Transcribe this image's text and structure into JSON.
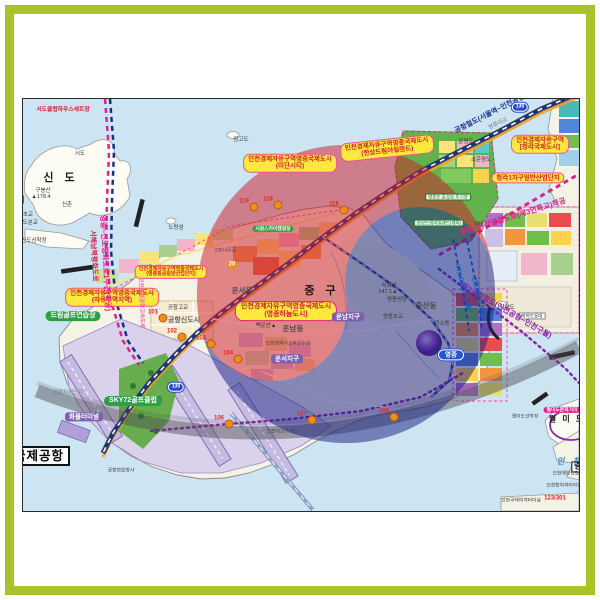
{
  "palette": {
    "frame_green": "#a9c32b",
    "water": "#cde4f3",
    "land": "#f5f2e6",
    "taegeuk_red": "rgba(205,30,45,0.52)",
    "taegeuk_blue": "rgba(30,35,130,0.52)",
    "swoosh_gray": "rgba(74,74,80,0.45)",
    "fez_label_bg": "#ffe93d",
    "fez_label_text": "#d61f2c"
  },
  "map": {
    "labels": [
      {
        "name": "label-midan-city",
        "cls": "fez",
        "x": 289,
        "y": 162,
        "lines": [
          "인천경제자유구역영종국제도시",
          "(미단시티)"
        ]
      },
      {
        "name": "label-hansang-dream-island",
        "cls": "fez",
        "x": 386,
        "y": 147,
        "rot": -6,
        "lines": [
          "인천경제자유구역영종국제도시",
          "(한상드림아일랜드)"
        ]
      },
      {
        "name": "label-cheongna-city",
        "cls": "fez",
        "x": 539,
        "y": 143,
        "lines": [
          "인천경제자유구역",
          "[청라국제도시]"
        ]
      },
      {
        "name": "label-cheongna1-industrial",
        "cls": "fez",
        "x": 527,
        "y": 177,
        "lines": [
          "청라1지구일반산업단지"
        ]
      },
      {
        "name": "label-yeongjong-aviation-industrial",
        "cls": "fez-sm",
        "x": 170,
        "y": 271,
        "lines": [
          "인천경제자유구역영종국제도시",
          "(영종항공일반산업단지)"
        ]
      },
      {
        "name": "label-free-trade-zone",
        "cls": "fez",
        "x": 111,
        "y": 296,
        "lines": [
          "인천경제자유구역영종국제도시",
          "(자유무역지역)"
        ]
      },
      {
        "name": "label-yeongjong-sky-city",
        "cls": "fez-strong",
        "x": 285,
        "y": 310,
        "lines": [
          "인천경제자유구역영종국제도시",
          "(영종하늘도시)"
        ]
      },
      {
        "name": "label-dream-golf-range",
        "cls": "green",
        "x": 72,
        "y": 315,
        "lines": [
          "드림골프연습장"
        ]
      },
      {
        "name": "label-sky72-golf-club",
        "cls": "green",
        "x": 132,
        "y": 400,
        "lines": [
          "SKY72골프클럽"
        ]
      },
      {
        "name": "label-seaside-camp",
        "cls": "green-sm",
        "x": 272,
        "y": 228,
        "lines": [
          "시원스카이캠핑장"
        ]
      },
      {
        "name": "label-dredged-soil-site",
        "cls": "wg-tiny",
        "x": 447,
        "y": 196,
        "lines": [
          "영종도 준설토 투기장"
        ]
      },
      {
        "name": "label-hansang-dream-planned",
        "cls": "wg-tiny",
        "x": 438,
        "y": 222,
        "lines": [
          "한상드림아일랜드(계획)"
        ]
      },
      {
        "name": "label-cargo-terminal",
        "cls": "purple",
        "x": 83,
        "y": 416,
        "lines": [
          "화물터미널"
        ]
      },
      {
        "name": "label-unnam-district",
        "cls": "purple",
        "x": 347,
        "y": 316,
        "lines": [
          "운남지구"
        ]
      },
      {
        "name": "label-unseo-district",
        "cls": "purple",
        "x": 286,
        "y": 358,
        "lines": [
          "운서지구"
        ]
      },
      {
        "name": "label-wolmido-culture-street",
        "cls": "pink",
        "x": 561,
        "y": 409,
        "lines": [
          "월미도문화거리"
        ]
      },
      {
        "name": "label-international-airport",
        "cls": "airport-box",
        "x": 38,
        "y": 455,
        "lines": [
          "국제공항"
        ]
      },
      {
        "name": "label-jung-partial",
        "cls": "box-sm",
        "x": 577,
        "y": 466,
        "lines": [
          "중"
        ]
      },
      {
        "name": "label-jagyakdo-lighthouse",
        "cls": "white-tiny",
        "x": 531,
        "y": 315,
        "lines": [
          "작약도등대"
        ]
      },
      {
        "name": "label-yeongjong-station",
        "cls": "capsule",
        "x": 450,
        "y": 354,
        "lines": [
          "영종"
        ]
      },
      {
        "name": "label-sido-clubhouse-set",
        "cls": "red-tiny",
        "x": 62,
        "y": 109,
        "lines": [
          "시도클럽하우스세트장"
        ]
      },
      {
        "name": "label-sindo-island",
        "cls": "big-black",
        "x": 60,
        "y": 177,
        "lines": [
          "신 도"
        ]
      },
      {
        "name": "label-gubongsan",
        "cls": "tiny",
        "x": 42,
        "y": 190,
        "lines": [
          "구봉산"
        ]
      },
      {
        "name": "label-gubongsan-height",
        "cls": "tiny",
        "x": 40,
        "y": 196,
        "lines": [
          "▲178.4"
        ]
      },
      {
        "name": "label-dori",
        "cls": "bold-sm",
        "x": 14,
        "y": 200,
        "lines": [
          "도 리"
        ]
      },
      {
        "name": "label-sinchon",
        "cls": "tiny",
        "x": 66,
        "y": 204,
        "lines": [
          "신촌"
        ]
      },
      {
        "name": "label-sido",
        "cls": "tiny",
        "x": 79,
        "y": 153,
        "lines": [
          "시도"
        ]
      },
      {
        "name": "label-norangseom",
        "cls": "tiny",
        "x": 175,
        "y": 227,
        "lines": [
          "노랑섬"
        ]
      },
      {
        "name": "label-sindo-dock",
        "cls": "tiny",
        "x": 33,
        "y": 240,
        "lines": [
          "신도선착장"
        ]
      },
      {
        "name": "label-sinheung-school",
        "cls": "tiny",
        "x": 22,
        "y": 214,
        "lines": [
          "신흥초교"
        ]
      },
      {
        "name": "label-sido-branch-school",
        "cls": "tiny",
        "x": 24,
        "y": 222,
        "lines": [
          "▲시도분교"
        ]
      },
      {
        "name": "label-janggodo",
        "cls": "tiny",
        "x": 240,
        "y": 139,
        "lines": [
          "장고도"
        ]
      },
      {
        "name": "label-yeongjong-bridge",
        "cls": "tiny-gray",
        "x": 497,
        "y": 123,
        "rot": -25,
        "lines": [
          "영종대교"
        ]
      },
      {
        "name": "label-unyeomdo",
        "cls": "tiny",
        "x": 465,
        "y": 141,
        "lines": [
          "운염도"
        ]
      },
      {
        "name": "label-sounyeomdo",
        "cls": "tiny",
        "x": 480,
        "y": 159,
        "lines": [
          "소운염도"
        ]
      },
      {
        "name": "label-maedo",
        "cls": "tiny",
        "x": 479,
        "y": 224,
        "lines": [
          "매도"
        ]
      },
      {
        "name": "label-jung-gu",
        "cls": "big-black",
        "x": 321,
        "y": 290,
        "lines": [
          "중 구"
        ]
      },
      {
        "name": "label-unseo-dong",
        "cls": "town",
        "x": 241,
        "y": 290,
        "lines": [
          "운서동"
        ]
      },
      {
        "name": "label-unnam-dong",
        "cls": "town",
        "x": 292,
        "y": 328,
        "lines": [
          "운남동"
        ]
      },
      {
        "name": "label-jungsan-dong",
        "cls": "town",
        "x": 425,
        "y": 305,
        "lines": [
          "중산동"
        ]
      },
      {
        "name": "label-seokhwasan",
        "cls": "tiny",
        "x": 388,
        "y": 285,
        "lines": [
          "석화산"
        ]
      },
      {
        "name": "label-seokhwasan-height",
        "cls": "tiny",
        "x": 387,
        "y": 291,
        "lines": [
          "147.1▲"
        ]
      },
      {
        "name": "label-yeongjong-cathedral",
        "cls": "tiny",
        "x": 396,
        "y": 299,
        "lines": [
          "영종성당"
        ]
      },
      {
        "name": "label-yeongjong-school",
        "cls": "tiny",
        "x": 392,
        "y": 316,
        "lines": [
          "영종초교"
        ]
      },
      {
        "name": "label-baegunsan",
        "cls": "tiny",
        "x": 265,
        "y": 325,
        "lines": [
          "백운산▲"
        ]
      },
      {
        "name": "label-education-institute",
        "cls": "micro",
        "x": 287,
        "y": 343,
        "lines": [
          "인천광역시교육연수원"
        ]
      },
      {
        "name": "label-airport-new-town",
        "cls": "town-sm",
        "x": 183,
        "y": 320,
        "lines": [
          "공항신도시"
        ]
      },
      {
        "name": "label-airport-high-school",
        "cls": "tiny",
        "x": 177,
        "y": 307,
        "lines": [
          "공항고교"
        ]
      },
      {
        "name": "label-airport-support-complex",
        "cls": "tiny-gray",
        "x": 67,
        "y": 392,
        "lines": [
          "공항지원단지"
        ]
      },
      {
        "name": "label-jagyakdo",
        "cls": "tiny",
        "x": 506,
        "y": 307,
        "lines": [
          "작약도"
        ]
      },
      {
        "name": "label-wolmido",
        "cls": "bold-sm",
        "x": 566,
        "y": 419,
        "lines": [
          "월 미 도"
        ]
      },
      {
        "name": "label-wolmido-dock",
        "cls": "micro",
        "x": 524,
        "y": 416,
        "lines": [
          "월미도선착장"
        ]
      },
      {
        "name": "label-incheon-sea",
        "cls": "blue-water",
        "x": 569,
        "y": 461,
        "lines": [
          "인 천"
        ]
      },
      {
        "name": "label-maritime-police",
        "cls": "micro",
        "x": 567,
        "y": 473,
        "lines": [
          "인천해양경찰청"
        ]
      },
      {
        "name": "label-incheon-port-terminal",
        "cls": "micro",
        "x": 563,
        "y": 485,
        "lines": [
          "인천항여객터미널"
        ]
      },
      {
        "name": "label-intl-ferry-terminal",
        "cls": "micro",
        "x": 520,
        "y": 500,
        "lines": [
          "인천국제여객터미널"
        ]
      },
      {
        "name": "label-incheon-bridge-memorial",
        "cls": "micro",
        "x": 281,
        "y": 431,
        "lines": [
          "인천대교기념관"
        ]
      },
      {
        "name": "label-gojan-namugol",
        "cls": "micro",
        "x": 224,
        "y": 250,
        "lines": [
          "고잔나무골"
        ]
      },
      {
        "name": "label-jeonso-dong",
        "cls": "tiny",
        "x": 441,
        "y": 323,
        "lines": [
          "전소동"
        ]
      },
      {
        "name": "label-do-partial",
        "cls": "big-black",
        "x": 16,
        "y": 369,
        "lines": [
          "도"
        ]
      },
      {
        "name": "label-terminal2",
        "cls": "micro-purple",
        "x": 12,
        "y": 441,
        "lines": [
          "제2터미널"
        ]
      },
      {
        "name": "label-airport-cargo-office",
        "cls": "micro",
        "x": 120,
        "y": 470,
        "lines": [
          "공항화물청사"
        ]
      },
      {
        "name": "route-airport-railroad",
        "cls": "rt-navy",
        "x": 490,
        "y": 113,
        "rot": -27,
        "lines": [
          "공항철도(서울역~인천공항)"
        ]
      },
      {
        "name": "route-third-bridge",
        "cls": "rt-magenta",
        "x": 512,
        "y": 216,
        "rot": -17,
        "lines": [
          "영종~청라연결도로(제3연륙교)착공"
        ]
      },
      {
        "name": "route-second-airport-rail",
        "cls": "rt-purple",
        "x": 505,
        "y": 310,
        "rot": 30,
        "lines": [
          "제2공항철도(인천공항~인천구월)"
        ]
      },
      {
        "name": "route-gtx-d",
        "cls": "rt-blue",
        "x": 461,
        "y": 286,
        "rot": 75,
        "lines": [
          "GTX-D(인천~구월)"
        ]
      },
      {
        "name": "route-incheon-subway2",
        "cls": "rt-blue-sm",
        "x": 477,
        "y": 295,
        "rot": 75,
        "lines": [
          "인천지하철2호선"
        ]
      },
      {
        "name": "route-peace-road-section1",
        "cls": "rt-magenta",
        "x": 104,
        "y": 262,
        "rot": 87,
        "lines": [
          "영종~신도평화도로1구간(착공)"
        ]
      },
      {
        "name": "route-west-sea-peace-road",
        "cls": "rt-crimson",
        "x": 92,
        "y": 255,
        "rot": 87,
        "lines": [
          "서해남북평화도로"
        ]
      },
      {
        "name": "route-airport-expressway",
        "cls": "rt-pink",
        "x": 140,
        "y": 302,
        "rot": 88,
        "lines": [
          "인천국제공항고속도로"
        ]
      },
      {
        "name": "badge-bus-20",
        "cls": "badge20",
        "x": 231,
        "y": 264,
        "lines": [
          "20"
        ]
      },
      {
        "name": "shield-130-a",
        "cls": "shield",
        "x": 519,
        "y": 106,
        "lines": [
          "130"
        ]
      },
      {
        "name": "shield-130-b",
        "cls": "shield",
        "x": 175,
        "y": 386,
        "lines": [
          "130"
        ]
      }
    ],
    "markers": [
      {
        "t": "119",
        "x": 243,
        "y": 201
      },
      {
        "t": "118",
        "x": 267,
        "y": 199
      },
      {
        "t": "116",
        "x": 333,
        "y": 204
      },
      {
        "t": "101",
        "x": 152,
        "y": 312
      },
      {
        "t": "102",
        "x": 171,
        "y": 331
      },
      {
        "t": "103",
        "x": 200,
        "y": 338
      },
      {
        "t": "104",
        "x": 227,
        "y": 353
      },
      {
        "t": "106",
        "x": 218,
        "y": 418
      },
      {
        "t": "107",
        "x": 301,
        "y": 414
      },
      {
        "t": "108",
        "x": 383,
        "y": 411
      },
      {
        "t": "123/301",
        "x": 554,
        "y": 498
      }
    ]
  }
}
